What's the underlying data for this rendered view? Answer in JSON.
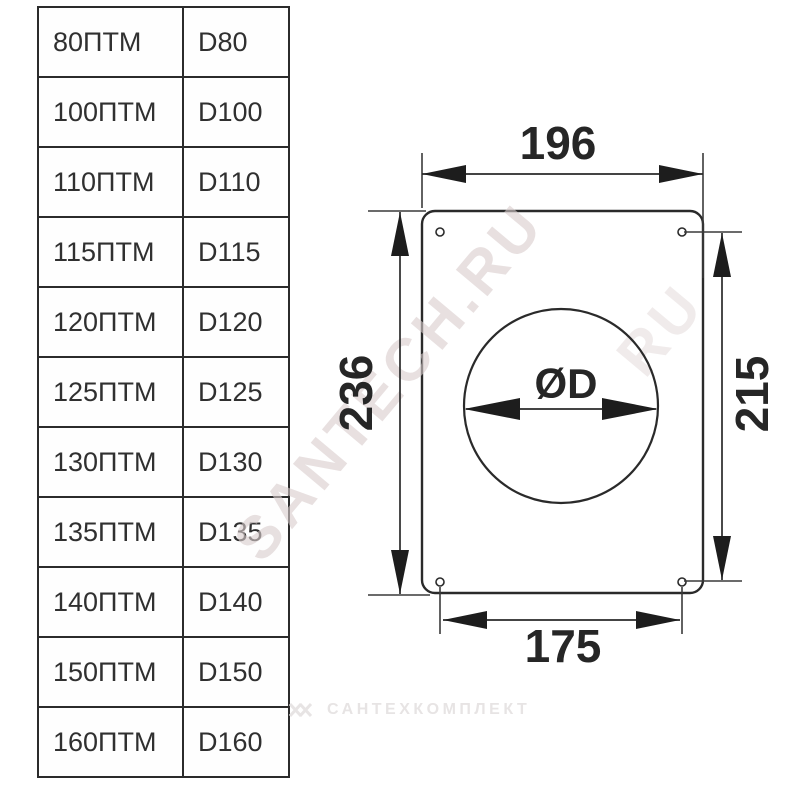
{
  "table": {
    "rows": [
      {
        "model": "80ПТМ",
        "diameter": "D80"
      },
      {
        "model": "100ПТМ",
        "diameter": "D100"
      },
      {
        "model": "110ПТМ",
        "diameter": "D110"
      },
      {
        "model": "115ПТМ",
        "diameter": "D115"
      },
      {
        "model": "120ПТМ",
        "diameter": "D120"
      },
      {
        "model": "125ПТМ",
        "diameter": "D125"
      },
      {
        "model": "130ПТМ",
        "diameter": "D130"
      },
      {
        "model": "135ПТМ",
        "diameter": "D135"
      },
      {
        "model": "140ПТМ",
        "diameter": "D140"
      },
      {
        "model": "150ПТМ",
        "diameter": "D150"
      },
      {
        "model": "160ПТМ",
        "diameter": "D160"
      }
    ]
  },
  "drawing": {
    "dim_top_width": "196",
    "dim_left_height": "236",
    "dim_right_height": "215",
    "dim_bottom_width": "175",
    "dim_hole_diameter": "ØD"
  },
  "watermarks": {
    "diagonal_text": "SANTECH.RU",
    "diagonal_fragment": "RU",
    "bottom_text": "САНТЕХКОМПЛЕКТ"
  },
  "colors": {
    "line": "#2a2a2a",
    "text": "#303030",
    "watermark_diagonal": "#d9cdcd",
    "watermark_bottom": "#e7e4e4"
  }
}
